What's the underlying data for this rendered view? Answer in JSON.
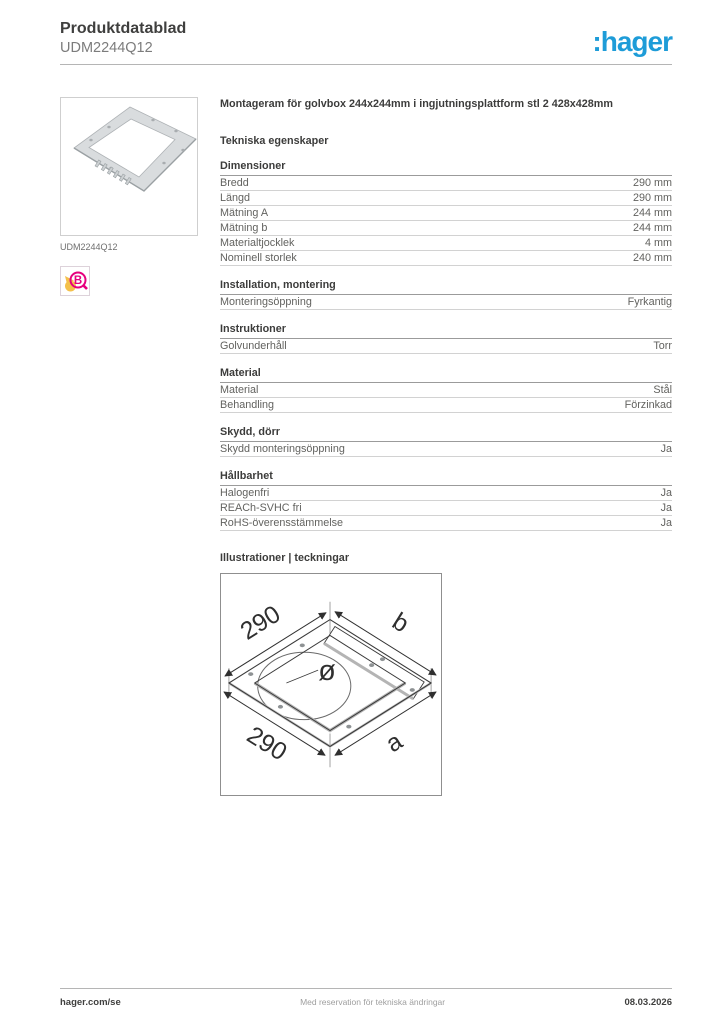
{
  "header": {
    "title": "Produktdatablad",
    "product_ref": "UDM2244Q12",
    "logo_text": ":hager"
  },
  "colors": {
    "brand_blue": "#1e9cd8",
    "cert_magenta": "#e6007e",
    "cert_yellow": "#f4c04a"
  },
  "sidebar": {
    "image_caption": "UDM2244Q12",
    "cert_letter": "B"
  },
  "main": {
    "product_title": "Montageram för golvbox 244x244mm i ingjutningsplattform stl 2 428x428mm",
    "section_title": "Tekniska egenskaper",
    "groups": [
      {
        "title": "Dimensioner",
        "rows": [
          {
            "label": "Bredd",
            "value": "290 mm"
          },
          {
            "label": "Längd",
            "value": "290 mm"
          },
          {
            "label": "Mätning A",
            "value": "244 mm"
          },
          {
            "label": "Mätning b",
            "value": "244 mm"
          },
          {
            "label": "Materialtjocklek",
            "value": "4 mm"
          },
          {
            "label": "Nominell storlek",
            "value": "240 mm"
          }
        ]
      },
      {
        "title": "Installation, montering",
        "rows": [
          {
            "label": "Monteringsöppning",
            "value": "Fyrkantig"
          }
        ]
      },
      {
        "title": "Instruktioner",
        "rows": [
          {
            "label": "Golvunderhåll",
            "value": "Torr"
          }
        ]
      },
      {
        "title": "Material",
        "rows": [
          {
            "label": "Material",
            "value": "Stål"
          },
          {
            "label": "Behandling",
            "value": "Förzinkad"
          }
        ]
      },
      {
        "title": "Skydd, dörr",
        "rows": [
          {
            "label": "Skydd monteringsöppning",
            "value": "Ja"
          }
        ]
      },
      {
        "title": "Hållbarhet",
        "rows": [
          {
            "label": "Halogenfri",
            "value": "Ja"
          },
          {
            "label": "REACh-SVHC fri",
            "value": "Ja"
          },
          {
            "label": "RoHS-överensstämmelse",
            "value": "Ja"
          }
        ]
      }
    ],
    "illustrations_title": "Illustrationer | teckningar",
    "illustration": {
      "dim_top": "290",
      "dim_bottom": "290",
      "label_b": "b",
      "label_a": "a",
      "diameter": "ø"
    }
  },
  "footer": {
    "site": "hager.com/se",
    "disclaimer": "Med reservation för tekniska ändringar",
    "date": "08.03.2026"
  }
}
